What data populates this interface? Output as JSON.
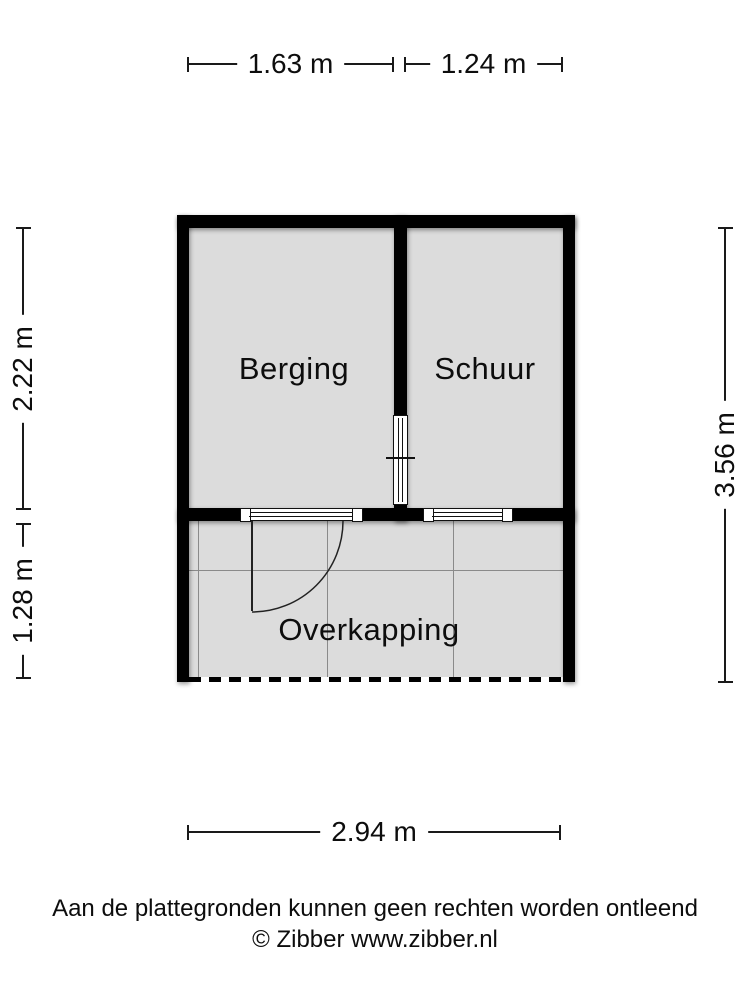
{
  "plan": {
    "rooms": [
      {
        "name": "berging",
        "label": "Berging"
      },
      {
        "name": "schuur",
        "label": "Schuur"
      },
      {
        "name": "overkapping",
        "label": "Overkapping"
      }
    ],
    "dimensions": {
      "top_left": "1.63 m",
      "top_right": "1.24 m",
      "left_upper": "2.22 m",
      "left_lower": "1.28 m",
      "right_side": "3.56 m",
      "bottom": "2.94 m"
    },
    "features": [
      "window-left",
      "window-right",
      "window-interior",
      "door-swing"
    ]
  },
  "footer": {
    "disclaimer": "Aan de plattegronden kunnen geen rechten worden ontleend",
    "copyright": "© Zibber www.zibber.nl"
  },
  "colors": {
    "wall": "#000000",
    "floor_fill": "#dcdcdc",
    "dimension_line": "#1a1a1a",
    "grid_line": "#8a8a8a",
    "background": "#ffffff"
  }
}
